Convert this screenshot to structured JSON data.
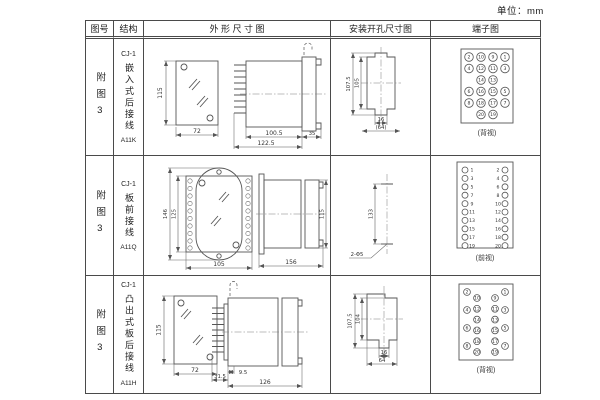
{
  "unit_label": "单位：mm",
  "table": {
    "headers": {
      "figure_no": "图号",
      "structure": "结构",
      "outline": "外 形 尺 寸 图",
      "install": "安装开孔尺寸图",
      "terminal": "端子图"
    },
    "rows": [
      {
        "figure_no": "附图3",
        "model": "CJ-1",
        "structure": "嵌入式后接线",
        "code": "A11K",
        "outline": {
          "height": "115",
          "width": "72",
          "depth1": "100.5",
          "depth2": "122.5",
          "flange": "35"
        },
        "install": {
          "outer_height": "107.5",
          "inner_height": "105",
          "slot_width": "16",
          "outer_width": "(64)"
        },
        "terminal": {
          "caption": "(背视)",
          "grid": [
            [
              2,
              10,
              9,
              1
            ],
            [
              4,
              12,
              11,
              3
            ],
            [
              null,
              14,
              13,
              null
            ],
            [
              6,
              16,
              15,
              5
            ],
            [
              8,
              18,
              17,
              7
            ],
            [
              null,
              20,
              19,
              null
            ]
          ]
        }
      },
      {
        "figure_no": "附图3",
        "model": "CJ-1",
        "structure": "板前接线",
        "code": "A11Q",
        "outline": {
          "height": "146",
          "inner_height": "125",
          "width": "105",
          "depth": "156",
          "side_height": "115"
        },
        "install": {
          "hole_spacing": "133",
          "hole_note": "2-Φ5"
        },
        "terminal": {
          "caption": "(前视)",
          "pairs": [
            [
              1,
              2
            ],
            [
              3,
              4
            ],
            [
              5,
              6
            ],
            [
              7,
              8
            ],
            [
              9,
              10
            ],
            [
              11,
              12
            ],
            [
              13,
              14
            ],
            [
              15,
              16
            ],
            [
              17,
              18
            ],
            [
              19,
              20
            ]
          ]
        }
      },
      {
        "figure_no": "附图3",
        "model": "CJ-1",
        "structure": "凸出式板后接线",
        "code": "A11H",
        "outline": {
          "height": "115",
          "width": "72",
          "pin_offset": "9.5",
          "pin_depth": "31.5",
          "depth": "126"
        },
        "install": {
          "outer_height": "107.5",
          "inner_height": "104",
          "slot_width": "16",
          "outer_width": "64"
        },
        "terminal": {
          "caption": "(背视)",
          "columns": [
            [
              2,
              4,
              6,
              8
            ],
            [
              10,
              12,
              14,
              16,
              18,
              20
            ],
            [
              9,
              11,
              13,
              15,
              17,
              19
            ],
            [
              1,
              3,
              5,
              7
            ]
          ]
        }
      }
    ]
  }
}
